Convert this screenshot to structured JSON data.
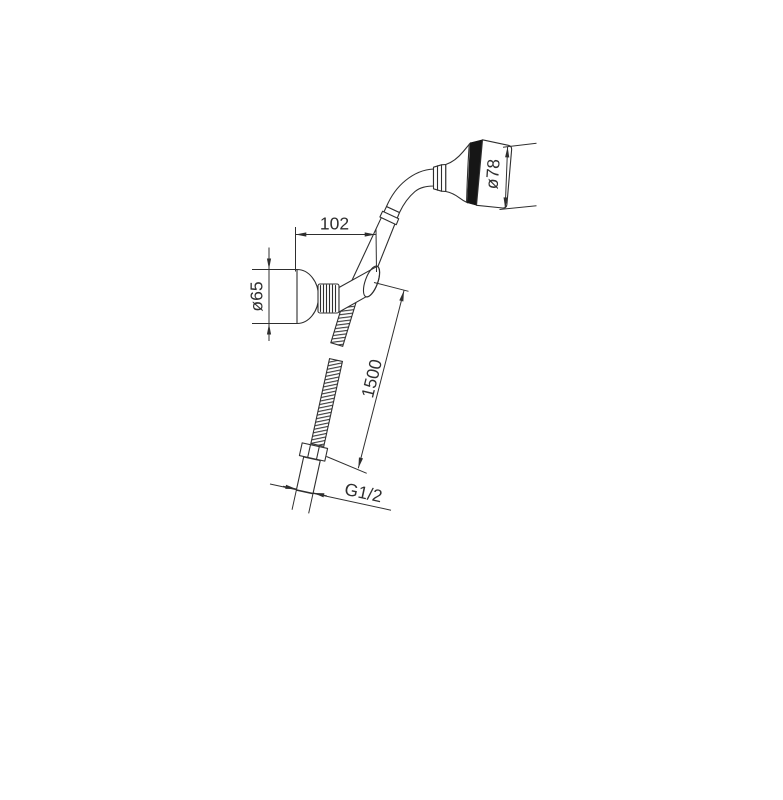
{
  "drawing": {
    "background": "#ffffff",
    "line_color": "#2e2e2e",
    "dimension_labels": {
      "holder_offset": "102",
      "holder_diameter": "ø65",
      "head_diameter": "ø78",
      "hose_length": "1500",
      "thread_size": "G1/2"
    }
  }
}
